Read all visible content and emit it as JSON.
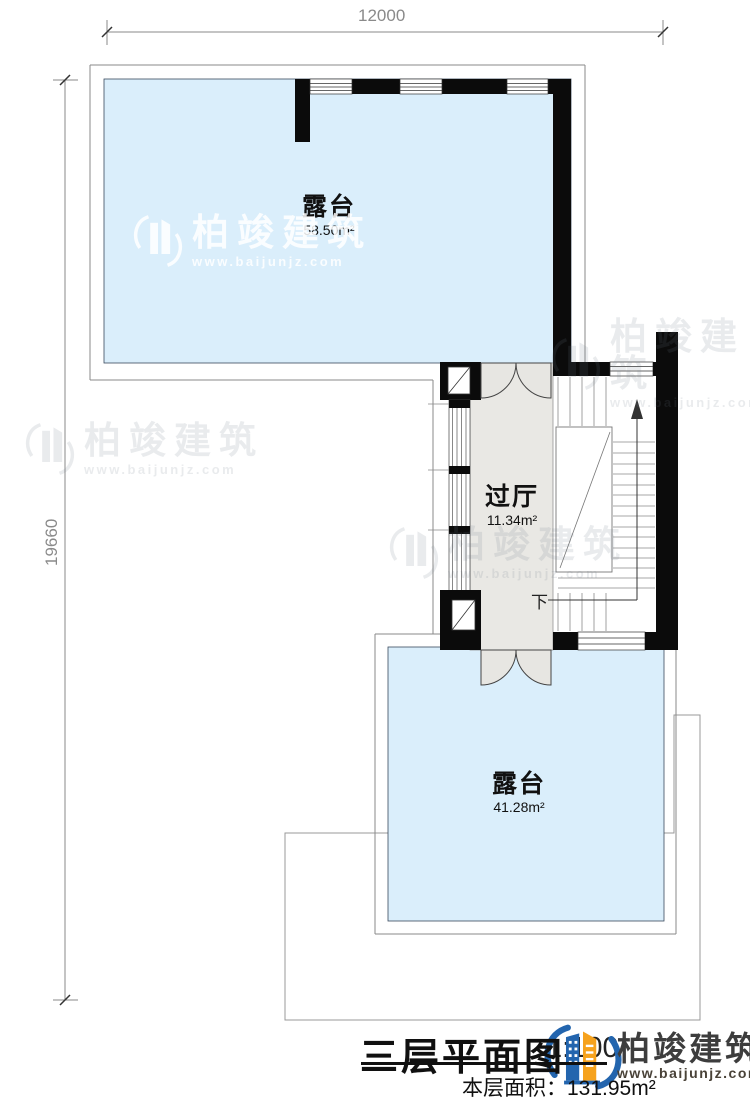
{
  "colors": {
    "terrace_fill": "#daeefb",
    "hall_fill": "#e9e8e4",
    "door_fill": "#e7e6e2",
    "wall": "#0b0b0b",
    "logo_blue": "#2365ae",
    "logo_orange": "#f6a21d",
    "logo_text": "#3d3d3d"
  },
  "dimensions": {
    "top": "12000",
    "left": "19660"
  },
  "rooms": {
    "upper_terrace": {
      "name": "露台",
      "area": "58.50m²"
    },
    "hall": {
      "name": "过厅",
      "area": "11.34m²"
    },
    "lower_terrace": {
      "name": "露台",
      "area": "41.28m²"
    }
  },
  "stairs": {
    "down_label": "下"
  },
  "titleblock": {
    "title": "三层平面图",
    "scale": "1:100",
    "area_label": "本层面积：",
    "area_value": "131.95m²"
  },
  "brand": {
    "name": "柏竣建筑",
    "url": "www.baijunjz.com"
  },
  "watermark": {
    "name": "柏竣建筑",
    "url": "www.baijunjz.com"
  }
}
